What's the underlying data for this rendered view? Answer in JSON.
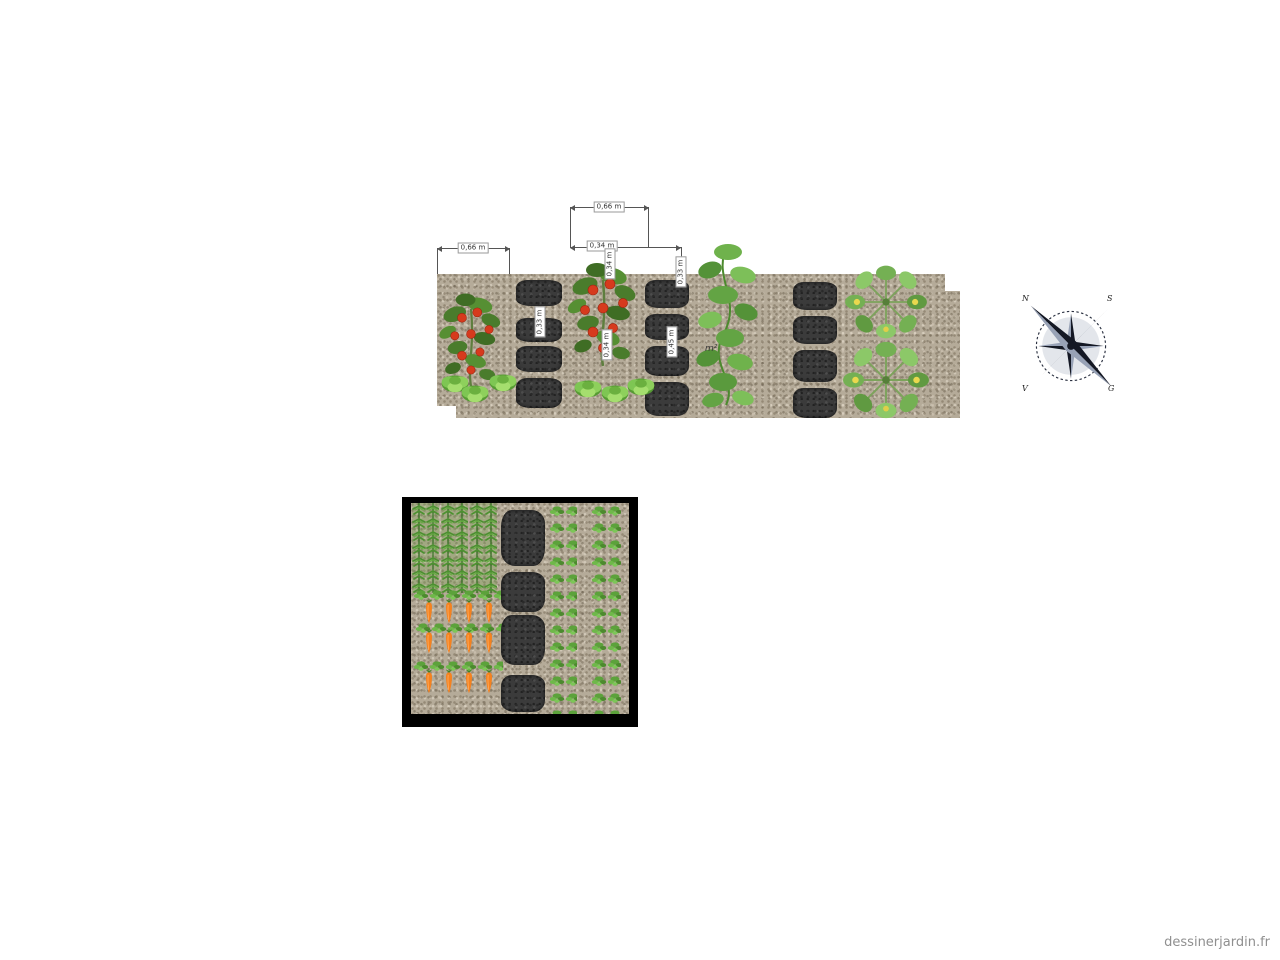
{
  "page": {
    "background_color": "#ffffff",
    "watermark": "dessinerjardin.fr"
  },
  "top_bed": {
    "description": "elevation strip of a gravel bed with plants and paving stones",
    "dim_labels": {
      "left": "0,66 m",
      "top": "0,66 m",
      "mid": "0,34 m",
      "right_drop": "0,33 m",
      "stone_col1": "0,33 m",
      "stem_upper": "0,34 m",
      "stem_lower": "0,34 m",
      "stone_col2": "0,45 m"
    },
    "area_label": "m²",
    "plants": [
      {
        "name": "tomato-plant"
      },
      {
        "name": "lettuce-heads"
      },
      {
        "name": "tomato-plant"
      },
      {
        "name": "lettuce-heads"
      },
      {
        "name": "cucumber-vines"
      },
      {
        "name": "courgette-plants"
      }
    ],
    "colors": {
      "gravel": "#b5ab99",
      "stone": "#3b3b3b",
      "tomato_red": "#d63a1d"
    }
  },
  "plot": {
    "description": "square plot plan with carrot block, paving stone path and seedling rows",
    "border_color": "#000000",
    "contents": [
      {
        "name": "carrot-foliage-block"
      },
      {
        "name": "carrot-root-rows"
      },
      {
        "name": "paving-stone-path"
      },
      {
        "name": "seedling-row"
      },
      {
        "name": "seedling-row"
      }
    ],
    "colors": {
      "carrot_orange": "#f5821f",
      "foliage_green": "#4c9130"
    }
  },
  "compass": {
    "labels": {
      "top_left": "N",
      "top_right": "S",
      "bottom_left": "V",
      "bottom_right": "G"
    },
    "colors": {
      "dark": "#141824",
      "light": "#98a2b6"
    }
  }
}
